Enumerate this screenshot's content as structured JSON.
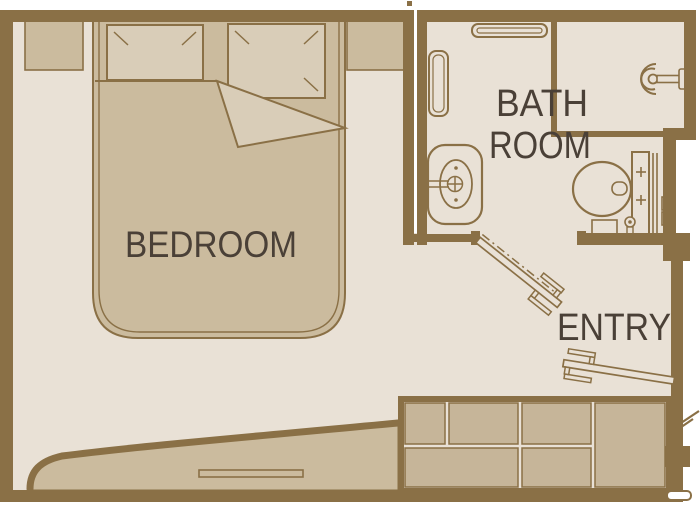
{
  "colors": {
    "background": "#ffffff",
    "wall": "#8a7046",
    "floor": "#e9e1d6",
    "furniture": "#cbbb9e",
    "furniture_light": "#d9cdb8",
    "wardrobe": "#c6b599",
    "ink": "#4a4037"
  },
  "floor_plan": {
    "rooms": [
      {
        "id": "bedroom",
        "label": "BEDROOM"
      },
      {
        "id": "bathroom",
        "label": [
          "BATH",
          "ROOM"
        ]
      },
      {
        "id": "entry",
        "label": "ENTRY"
      }
    ],
    "fixtures": [
      "double-bed",
      "pillow-left",
      "pillow-right",
      "nightstand-left",
      "nightstand-right",
      "bench-console",
      "wall-shelf",
      "wall-cabinet",
      "wash-basin",
      "toilet",
      "towel-radiator",
      "shower-screen",
      "shower-head",
      "bathroom-door",
      "entry-door",
      "wardrobe"
    ]
  }
}
